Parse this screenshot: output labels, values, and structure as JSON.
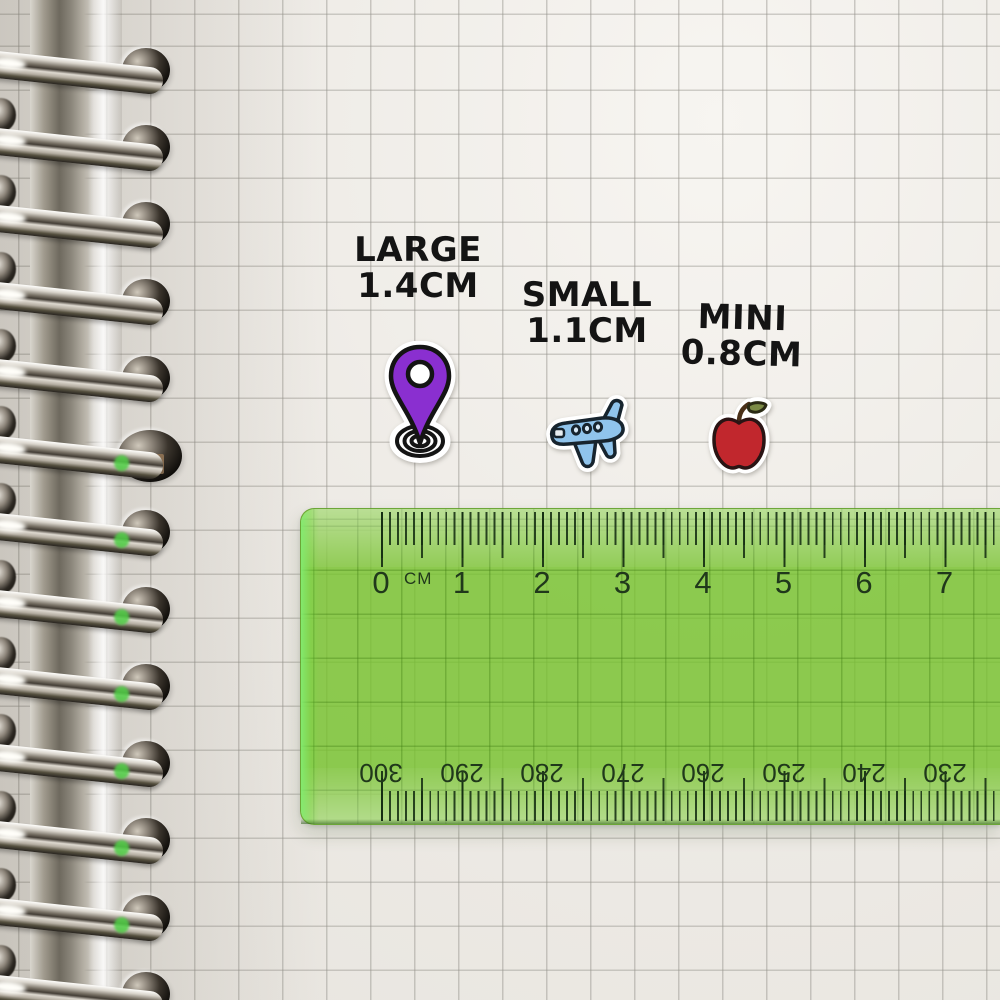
{
  "labels": {
    "large": {
      "name": "LARGE",
      "size": "1.4CM"
    },
    "small": {
      "name": "SMALL",
      "size": "1.1CM"
    },
    "mini": {
      "name": "MINI",
      "size": "0.8CM"
    }
  },
  "stickers": {
    "pin": {
      "icon": "location-pin-sticker",
      "color": "#8a2fd0"
    },
    "plane": {
      "icon": "airplane-sticker",
      "color": "#90c4ec"
    },
    "apple": {
      "icon": "apple-sticker",
      "color": "#c1272d"
    }
  },
  "ruler": {
    "unit_label": "CM",
    "top_scale_numbers": [
      "0",
      "1",
      "2",
      "3",
      "4",
      "5",
      "6",
      "7"
    ],
    "bottom_scale_numbers": [
      "300",
      "290",
      "280",
      "270",
      "260",
      "250",
      "240",
      "230"
    ],
    "body_color": "#8cc94e",
    "tick_color": "#1c2f18"
  },
  "colors": {
    "paper": "#eeebe6",
    "grid_line": "#c7c5c0",
    "label_text": "#141414"
  }
}
